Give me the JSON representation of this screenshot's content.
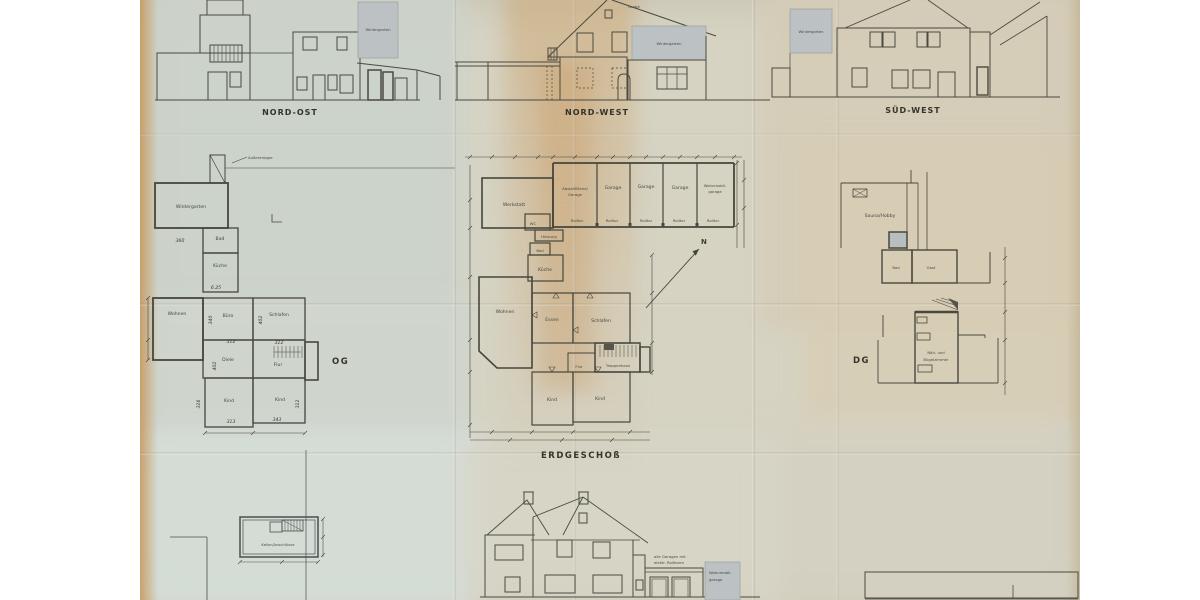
{
  "colors": {
    "paper_tan": "#d8cfba",
    "paper_grey_green": "#ccd3cb",
    "paper_blue_grey": "#d5ded9",
    "stain_orange": "#c79354",
    "line": "#4a4a40",
    "grey_fill": "#bcc1c3"
  },
  "elevations": {
    "nord_ost": {
      "title": "NORD-OST",
      "wintergarten": "Wintergarten"
    },
    "nord_west": {
      "title": "NORD-WEST",
      "laube": "Laube",
      "wintergarten": "Wintergarten"
    },
    "sued_west": {
      "title": "SÜD-WEST",
      "wintergarten": "Wintergarten"
    },
    "sued_ost": {
      "garage_note_1": "alle Garagen mit",
      "garage_note_2": "elektr. Rolltoren",
      "wohnmobil_1": "Wohnmobil-",
      "wohnmobil_2": "garage"
    }
  },
  "plans": {
    "og": {
      "title": "OG",
      "aussentreppe": "Außentreppe",
      "rooms": {
        "wintergarten": "Wintergarten",
        "bad": "Bad",
        "kueche": "Küche",
        "wohnen": "Wohnen",
        "buero": "Büro",
        "schlafen": "Schlafen",
        "diele": "Diele",
        "flur": "Flur",
        "kind": "Kind"
      },
      "dims": {
        "d360": "360",
        "d625": "6.25",
        "d340": "340",
        "d402": "402",
        "d312": "312",
        "d316": "316",
        "d313": "313",
        "d343": "343"
      }
    },
    "eg": {
      "title": "ERDGESCHOß",
      "north": "N",
      "rooms": {
        "werkstatt": "Werkstatt",
        "wc": "WC",
        "abstell_1": "Abstellfläche/",
        "abstell_2": "Garage",
        "garage": "Garage",
        "wohnmobil_1": "Wohnmobil-",
        "wohnmobil_2": "garage",
        "rolltor": "Rolltor",
        "heizung": "Heizung",
        "bad": "Bad",
        "kueche": "Küche",
        "wohnen": "Wohnen",
        "essen": "Essen",
        "schlafen": "Schlafen",
        "flur": "Flur",
        "treppenhaus": "Treppenhaus",
        "kind": "Kind"
      }
    },
    "dg": {
      "title": "DG",
      "rooms": {
        "sauna": "Sauna/Hobby",
        "bad": "Bad",
        "gast": "Gast",
        "naeh_1": "Näh- und",
        "naeh_2": "Bügelzimmer"
      }
    },
    "keller": {
      "room": "Keller/Anschlüsse"
    }
  }
}
